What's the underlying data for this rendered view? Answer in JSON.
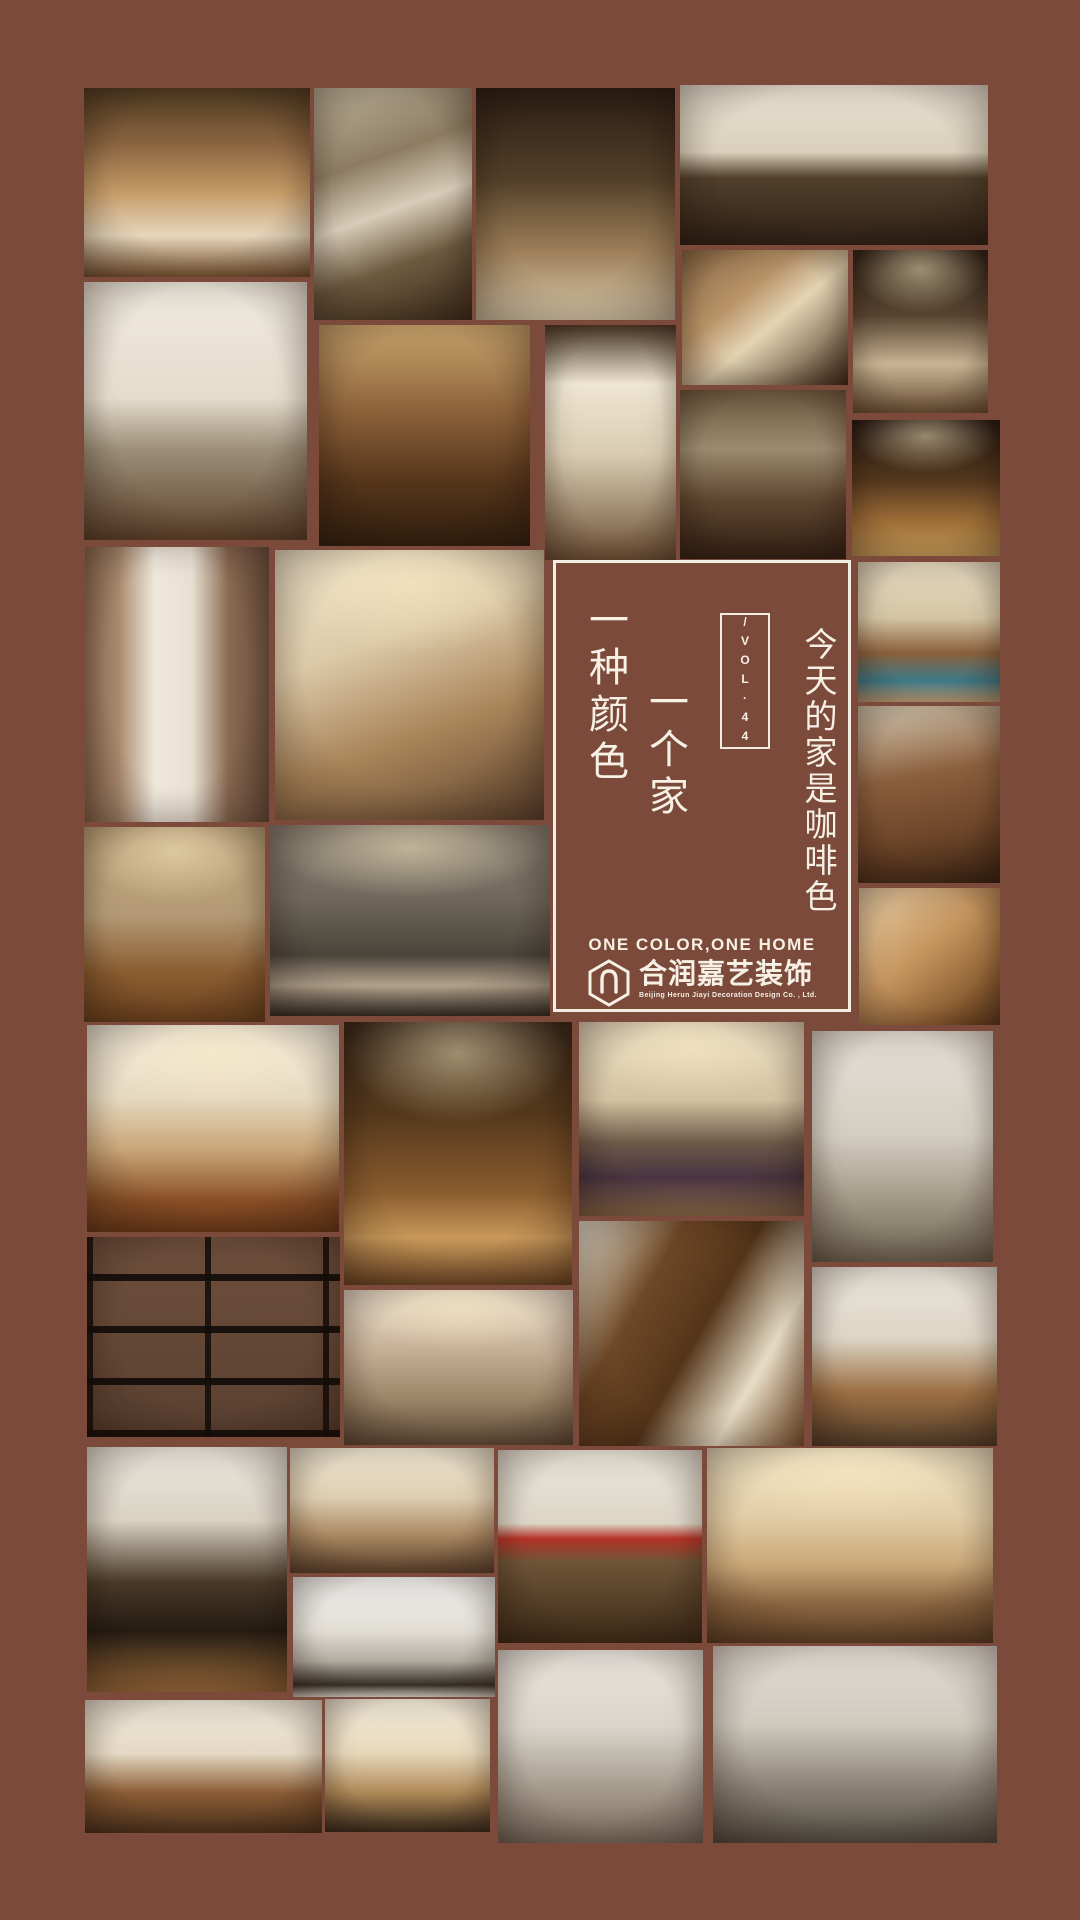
{
  "page": {
    "bg_color": "#7b4a3b",
    "width": 1080,
    "height": 1920
  },
  "panel": {
    "border_color": "#f3ece1",
    "slogan_col_1": "一种颜色",
    "slogan_col_2": "一个家",
    "vol_label": "/VOL·44",
    "title_vertical": "今天的家是咖啡色",
    "tagline_en": "ONE COLOR,ONE HOME",
    "brand_cn": "合润嘉艺装饰",
    "brand_en": "Beijing Herun Jiayi Decoration Design Co. , Ltd."
  },
  "photos": [
    {
      "name": "cowhide-pillow-sofa",
      "x": 84,
      "y": 88,
      "w": 226,
      "h": 189,
      "angle": 180,
      "glow": false,
      "stops": [
        [
          "#4f3a22",
          0
        ],
        [
          "#8a6540",
          30
        ],
        [
          "#c49a66",
          55
        ],
        [
          "#e6d6bc",
          78
        ],
        [
          "#7a5534",
          100
        ]
      ]
    },
    {
      "name": "stone-chimney-great-room",
      "x": 314,
      "y": 88,
      "w": 158,
      "h": 232,
      "angle": 160,
      "glow": false,
      "stops": [
        [
          "#bfb49c",
          0
        ],
        [
          "#8d7c62",
          32
        ],
        [
          "#d8cdb9",
          52
        ],
        [
          "#6e5a40",
          72
        ],
        [
          "#3f2e1c",
          100
        ]
      ]
    },
    {
      "name": "sheepskin-stools-lounge",
      "x": 476,
      "y": 88,
      "w": 199,
      "h": 232,
      "angle": 180,
      "glow": false,
      "stops": [
        [
          "#2a1d12",
          0
        ],
        [
          "#54402a",
          40
        ],
        [
          "#9c7e58",
          70
        ],
        [
          "#d9c9ac",
          100
        ]
      ]
    },
    {
      "name": "tufted-sofa-birch-wall",
      "x": 680,
      "y": 85,
      "w": 308,
      "h": 160,
      "angle": 180,
      "glow": false,
      "stops": [
        [
          "#eae3d4",
          0
        ],
        [
          "#d9cfba",
          42
        ],
        [
          "#52402c",
          58
        ],
        [
          "#2f2216",
          100
        ]
      ]
    },
    {
      "name": "wooden-bowl-detail",
      "x": 682,
      "y": 250,
      "w": 166,
      "h": 135,
      "angle": 140,
      "glow": false,
      "stops": [
        [
          "#8a6a46",
          0
        ],
        [
          "#b99468",
          35
        ],
        [
          "#e4d4b4",
          55
        ],
        [
          "#3f2a18",
          100
        ]
      ]
    },
    {
      "name": "drum-pendant-dining",
      "x": 853,
      "y": 250,
      "w": 135,
      "h": 163,
      "angle": 180,
      "glow": true,
      "stops": [
        [
          "#2f2317",
          0
        ],
        [
          "#574330",
          40
        ],
        [
          "#c9b494",
          70
        ],
        [
          "#6e5338",
          100
        ]
      ]
    },
    {
      "name": "spotlight-leather-sofa",
      "x": 84,
      "y": 282,
      "w": 223,
      "h": 258,
      "angle": 180,
      "glow": false,
      "stops": [
        [
          "#f0eadf",
          0
        ],
        [
          "#e4dccc",
          45
        ],
        [
          "#9c8e78",
          65
        ],
        [
          "#5f432c",
          100
        ]
      ]
    },
    {
      "name": "copper-bathtub",
      "x": 319,
      "y": 325,
      "w": 211,
      "h": 221,
      "angle": 180,
      "glow": false,
      "stops": [
        [
          "#caa66e",
          0
        ],
        [
          "#8a6038",
          40
        ],
        [
          "#56361c",
          70
        ],
        [
          "#33200f",
          100
        ]
      ]
    },
    {
      "name": "birch-floor-lamp",
      "x": 545,
      "y": 325,
      "w": 131,
      "h": 235,
      "angle": 180,
      "glow": false,
      "stops": [
        [
          "#4a3826",
          0
        ],
        [
          "#efe6d2",
          25
        ],
        [
          "#d9ccb2",
          55
        ],
        [
          "#6e5136",
          100
        ]
      ]
    },
    {
      "name": "stone-fireplace-living",
      "x": 680,
      "y": 390,
      "w": 166,
      "h": 169,
      "angle": 180,
      "glow": false,
      "stops": [
        [
          "#6e5a40",
          0
        ],
        [
          "#9c8b70",
          35
        ],
        [
          "#5f4630",
          65
        ],
        [
          "#332114",
          100
        ]
      ]
    },
    {
      "name": "lodge-loft-interior",
      "x": 852,
      "y": 420,
      "w": 148,
      "h": 136,
      "angle": 180,
      "glow": true,
      "stops": [
        [
          "#241811",
          0
        ],
        [
          "#54381e",
          45
        ],
        [
          "#a06e38",
          75
        ],
        [
          "#caa05c",
          100
        ]
      ]
    },
    {
      "name": "brown-curtains",
      "x": 85,
      "y": 547,
      "w": 184,
      "h": 275,
      "angle": 90,
      "glow": false,
      "stops": [
        [
          "#8a6a52",
          0
        ],
        [
          "#a98a6e",
          18
        ],
        [
          "#efe9dc",
          38
        ],
        [
          "#e9e0d2",
          58
        ],
        [
          "#8a6a52",
          78
        ],
        [
          "#6e5240",
          100
        ]
      ]
    },
    {
      "name": "tufted-headboard-bedroom",
      "x": 275,
      "y": 550,
      "w": 269,
      "h": 270,
      "angle": 160,
      "glow": true,
      "stops": [
        [
          "#efe4cc",
          0
        ],
        [
          "#dcc9a8",
          35
        ],
        [
          "#a88458",
          65
        ],
        [
          "#5f4530",
          100
        ]
      ]
    },
    {
      "name": "chinese-style-bedroom",
      "x": 858,
      "y": 562,
      "w": 142,
      "h": 140,
      "angle": 180,
      "glow": false,
      "stops": [
        [
          "#e8ddc4",
          0
        ],
        [
          "#d4c4a4",
          40
        ],
        [
          "#8a5f3a",
          65
        ],
        [
          "#3f7d8c",
          85
        ],
        [
          "#caa87c",
          100
        ]
      ]
    },
    {
      "name": "leather-sofa-cowhide",
      "x": 858,
      "y": 706,
      "w": 142,
      "h": 177,
      "angle": 170,
      "glow": false,
      "stops": [
        [
          "#d9ccb6",
          0
        ],
        [
          "#8a5f3c",
          40
        ],
        [
          "#6e462a",
          70
        ],
        [
          "#3a2414",
          100
        ]
      ]
    },
    {
      "name": "breakfast-bar-kitchen",
      "x": 84,
      "y": 827,
      "w": 181,
      "h": 195,
      "angle": 180,
      "glow": true,
      "stops": [
        [
          "#c2a87e",
          0
        ],
        [
          "#b39a74",
          45
        ],
        [
          "#8a5c30",
          75
        ],
        [
          "#6e441f",
          100
        ]
      ]
    },
    {
      "name": "taupe-bedroom",
      "x": 270,
      "y": 825,
      "w": 280,
      "h": 191,
      "angle": 180,
      "glow": true,
      "stops": [
        [
          "#8a8274",
          0
        ],
        [
          "#6e665a",
          40
        ],
        [
          "#4a443a",
          68
        ],
        [
          "#b2a38c",
          84
        ],
        [
          "#332e26",
          100
        ]
      ]
    },
    {
      "name": "fur-throw-detail",
      "x": 859,
      "y": 888,
      "w": 141,
      "h": 137,
      "angle": 140,
      "glow": false,
      "stops": [
        [
          "#e8d0a8",
          0
        ],
        [
          "#c79660",
          45
        ],
        [
          "#8a5c30",
          80
        ],
        [
          "#5f3c1e",
          100
        ]
      ]
    },
    {
      "name": "coffered-ceiling-bedroom",
      "x": 87,
      "y": 1025,
      "w": 252,
      "h": 207,
      "angle": 180,
      "glow": true,
      "stops": [
        [
          "#f2ecdc",
          0
        ],
        [
          "#e6d9c0",
          35
        ],
        [
          "#c9a678",
          60
        ],
        [
          "#8a4f26",
          85
        ],
        [
          "#6e3c1a",
          100
        ]
      ]
    },
    {
      "name": "lodge-loft-living",
      "x": 344,
      "y": 1022,
      "w": 228,
      "h": 263,
      "angle": 180,
      "glow": true,
      "stops": [
        [
          "#38281a",
          0
        ],
        [
          "#54381c",
          35
        ],
        [
          "#8a5c2e",
          65
        ],
        [
          "#c9985a",
          82
        ],
        [
          "#6e4826",
          100
        ]
      ]
    },
    {
      "name": "hotel-bedroom-purple",
      "x": 579,
      "y": 1022,
      "w": 225,
      "h": 194,
      "angle": 180,
      "glow": true,
      "stops": [
        [
          "#e9dcc2",
          0
        ],
        [
          "#d4c2a2",
          40
        ],
        [
          "#6e5a48",
          62
        ],
        [
          "#4a3442",
          80
        ],
        [
          "#8a6a4a",
          100
        ]
      ]
    },
    {
      "name": "gray-apartment-living",
      "x": 812,
      "y": 1031,
      "w": 181,
      "h": 231,
      "angle": 180,
      "glow": false,
      "stops": [
        [
          "#e5e0d6",
          0
        ],
        [
          "#d4cec2",
          45
        ],
        [
          "#a89e8c",
          70
        ],
        [
          "#6e6452",
          100
        ]
      ]
    },
    {
      "name": "brick-texture",
      "x": 87,
      "y": 1237,
      "w": 253,
      "h": 200,
      "angle": 180,
      "glow": false,
      "pattern": "brick",
      "stops": [
        [
          "#6e4f3c",
          0
        ],
        [
          "#5a4030",
          100
        ]
      ]
    },
    {
      "name": "wood-panel-living",
      "x": 579,
      "y": 1221,
      "w": 225,
      "h": 225,
      "angle": 120,
      "glow": false,
      "stops": [
        [
          "#f0ead8",
          0
        ],
        [
          "#6e4826",
          30
        ],
        [
          "#54351a",
          52
        ],
        [
          "#e6dcc6",
          75
        ],
        [
          "#8a5c34",
          100
        ]
      ]
    },
    {
      "name": "home-bar-counter",
      "x": 812,
      "y": 1267,
      "w": 185,
      "h": 179,
      "angle": 180,
      "glow": false,
      "stops": [
        [
          "#ece7dc",
          0
        ],
        [
          "#dcd4c4",
          40
        ],
        [
          "#9c6f42",
          70
        ],
        [
          "#54402c",
          100
        ]
      ]
    },
    {
      "name": "taupe-cove-living",
      "x": 344,
      "y": 1290,
      "w": 229,
      "h": 155,
      "angle": 180,
      "glow": true,
      "stops": [
        [
          "#efe3d0",
          0
        ],
        [
          "#c4ad94",
          40
        ],
        [
          "#9c8468",
          70
        ],
        [
          "#5f4c38",
          100
        ]
      ]
    },
    {
      "name": "cage-pendant-kitchen",
      "x": 87,
      "y": 1447,
      "w": 200,
      "h": 245,
      "angle": 180,
      "glow": false,
      "stops": [
        [
          "#ece8de",
          0
        ],
        [
          "#d9d2c2",
          30
        ],
        [
          "#4a3a28",
          55
        ],
        [
          "#241c12",
          75
        ],
        [
          "#9c6c3c",
          100
        ]
      ]
    },
    {
      "name": "beige-sectional-living",
      "x": 290,
      "y": 1448,
      "w": 204,
      "h": 125,
      "angle": 180,
      "glow": false,
      "stops": [
        [
          "#f0e8d4",
          0
        ],
        [
          "#decdb0",
          40
        ],
        [
          "#a88760",
          70
        ],
        [
          "#5f4530",
          100
        ]
      ]
    },
    {
      "name": "red-chair-living",
      "x": 498,
      "y": 1450,
      "w": 204,
      "h": 193,
      "angle": 180,
      "glow": false,
      "stops": [
        [
          "#ece7da",
          0
        ],
        [
          "#dcd5c6",
          38
        ],
        [
          "#b43326",
          46
        ],
        [
          "#6e5438",
          58
        ],
        [
          "#3f2c18",
          100
        ]
      ]
    },
    {
      "name": "chandelier-living",
      "x": 707,
      "y": 1448,
      "w": 286,
      "h": 195,
      "angle": 180,
      "glow": true,
      "stops": [
        [
          "#f0e2c4",
          0
        ],
        [
          "#e2cda6",
          35
        ],
        [
          "#c9a878",
          60
        ],
        [
          "#8a6540",
          80
        ],
        [
          "#5f4228",
          100
        ]
      ]
    },
    {
      "name": "white-minimal-study",
      "x": 293,
      "y": 1577,
      "w": 202,
      "h": 120,
      "angle": 180,
      "glow": false,
      "stops": [
        [
          "#f2f1ee",
          0
        ],
        [
          "#e2ded6",
          45
        ],
        [
          "#b2aca0",
          70
        ],
        [
          "#3a342c",
          90
        ],
        [
          "#e8e4dc",
          100
        ]
      ]
    },
    {
      "name": "gray-sofa-dining",
      "x": 498,
      "y": 1650,
      "w": 205,
      "h": 193,
      "angle": 180,
      "glow": false,
      "stops": [
        [
          "#eae6de",
          0
        ],
        [
          "#d9d4ca",
          40
        ],
        [
          "#a89e90",
          70
        ],
        [
          "#786a5c",
          100
        ]
      ]
    },
    {
      "name": "gray-sectional-frames",
      "x": 713,
      "y": 1646,
      "w": 284,
      "h": 197,
      "angle": 180,
      "glow": false,
      "stops": [
        [
          "#e2ddd4",
          0
        ],
        [
          "#cfc9be",
          40
        ],
        [
          "#8e8678",
          70
        ],
        [
          "#544e44",
          100
        ]
      ]
    },
    {
      "name": "ranch-living-room",
      "x": 85,
      "y": 1700,
      "w": 237,
      "h": 133,
      "angle": 180,
      "glow": false,
      "stops": [
        [
          "#f0e9da",
          0
        ],
        [
          "#e4d9c4",
          40
        ],
        [
          "#8a5c34",
          70
        ],
        [
          "#4f351f",
          100
        ]
      ]
    },
    {
      "name": "armchair-xox-detail",
      "x": 325,
      "y": 1699,
      "w": 165,
      "h": 133,
      "angle": 180,
      "glow": false,
      "stops": [
        [
          "#f4eddc",
          0
        ],
        [
          "#e8d9bc",
          40
        ],
        [
          "#b08a58",
          70
        ],
        [
          "#3a2c1e",
          100
        ]
      ]
    }
  ]
}
